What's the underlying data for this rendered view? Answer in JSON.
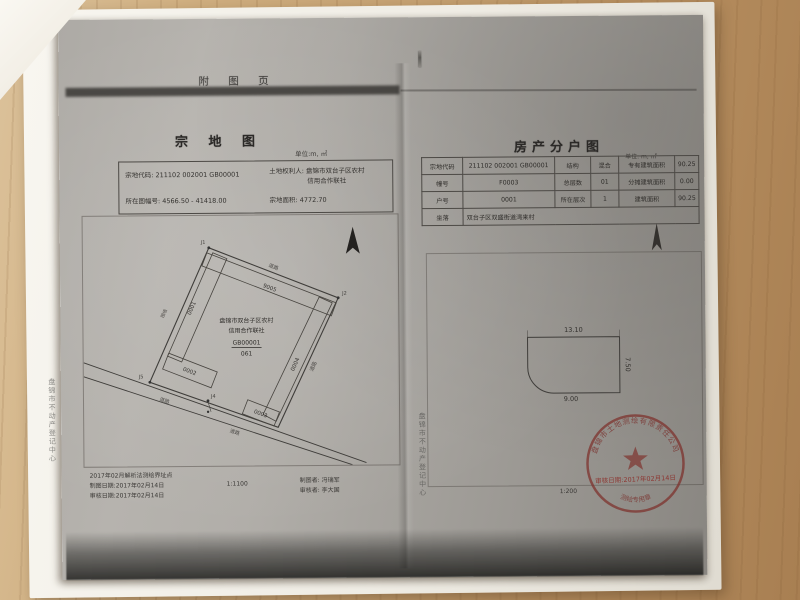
{
  "header": {
    "page_title": "附 图 页"
  },
  "left_page": {
    "title": "宗 地 图",
    "unit": "单位:m, ㎡",
    "info": {
      "parcel_code_label": "宗地代码:",
      "parcel_code": "211102 002001 GB00001",
      "holder_label": "土地权利人:",
      "holder_line1": "盘锦市双台子区农村",
      "holder_line2": "信用合作联社",
      "sheet_label": "所在图幅号:",
      "sheet_no": "4566.50 - 41418.00",
      "area_label": "宗地面积:",
      "area": "4772.70"
    },
    "sketch": {
      "point_j1": "J1",
      "point_j2": "J2",
      "point_j4": "J4",
      "point_j5": "J5",
      "top_strip": "9005",
      "left_strip": "0001",
      "rect": "0002",
      "small_rect": "0003",
      "right_strip": "0004",
      "owner_line1": "盘锦市双台子区农村",
      "owner_line2": "信用合作联社",
      "owner_code": "GB00001",
      "owner_den": "061",
      "road_top": "道路",
      "road_right": "道路",
      "road_a": "道路",
      "road_b": "道路",
      "wall": "围墙"
    },
    "footer": {
      "note1": "2017年02月解析法测绘界址点",
      "note2": "制图日期:2017年02月14日",
      "note3": "审核日期:2017年02月14日",
      "scale": "1:1100",
      "drafter": "制图者: 冯瑞军",
      "checker": "审核者: 李大国"
    },
    "side_text": "盘锦市不动产登记中心"
  },
  "right_page": {
    "title": "房产分户图",
    "unit": "单位: m, ㎡",
    "table": {
      "rows": [
        {
          "c": [
            "宗地代码",
            "211102 002001 GB00001",
            "结构",
            "混合",
            "专有建筑面积",
            "90.25"
          ]
        },
        {
          "c": [
            "幢号",
            "F0003",
            "总层数",
            "01",
            "分摊建筑面积",
            "0.00"
          ]
        },
        {
          "c": [
            "户号",
            "0001",
            "所在层次",
            "1",
            "建筑面积",
            "90.25"
          ]
        },
        {
          "c": [
            "坐落",
            "双台子区双盛街道湾来村"
          ]
        }
      ]
    },
    "plan": {
      "dim_top": "13.10",
      "dim_right": "7.50",
      "dim_bottom": "9.00",
      "scale": "1:200"
    },
    "stamp": {
      "ring_text": "盘锦市土地测绘有限责任公司",
      "date_line": "审核日期:2017年02月14日",
      "bottom_text": "测绘专用章"
    },
    "side_text": "盘锦市不动产登记中心"
  }
}
